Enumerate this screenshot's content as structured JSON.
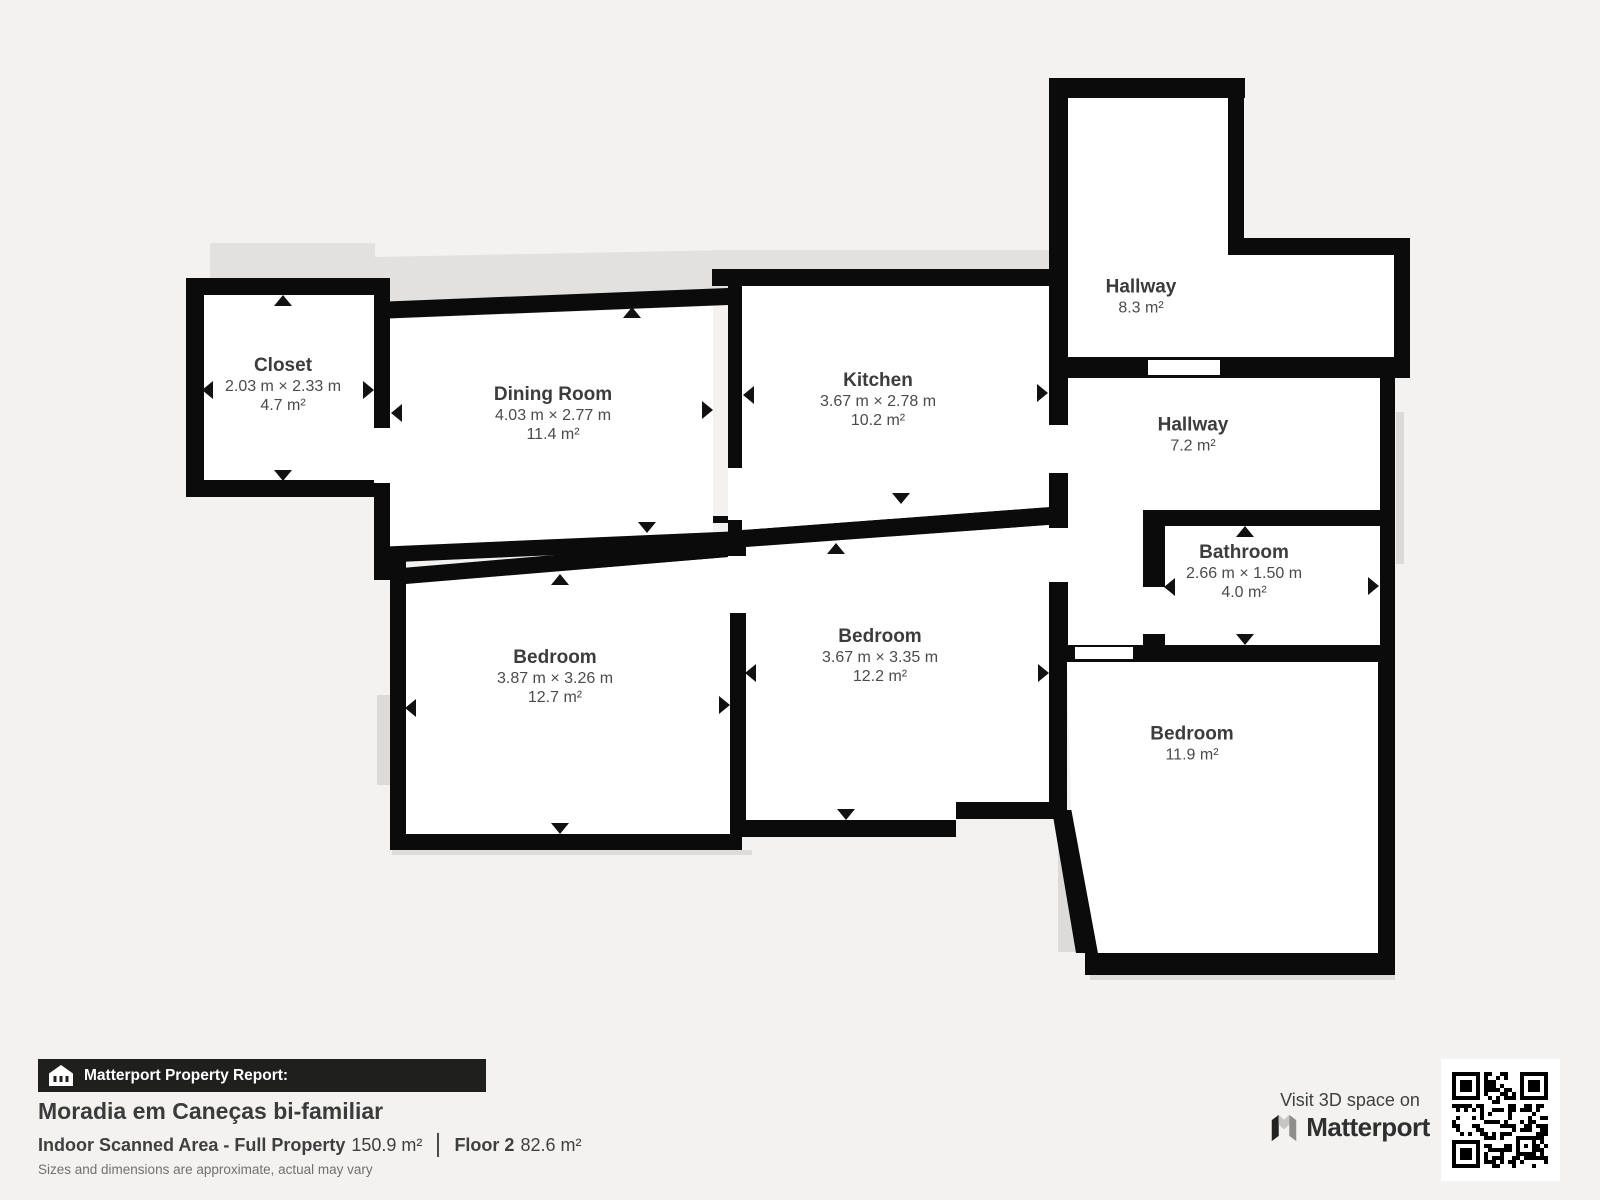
{
  "rooms": [
    {
      "name": "Closet",
      "dims": "2.03 m × 2.33 m",
      "area": "4.7 m²"
    },
    {
      "name": "Dining Room",
      "dims": "4.03 m × 2.77 m",
      "area": "11.4 m²"
    },
    {
      "name": "Kitchen",
      "dims": "3.67 m × 2.78 m",
      "area": "10.2 m²"
    },
    {
      "name": "Hallway",
      "dims": null,
      "area": "8.3 m²"
    },
    {
      "name": "Hallway",
      "dims": null,
      "area": "7.2 m²"
    },
    {
      "name": "Bathroom",
      "dims": "2.66 m × 1.50 m",
      "area": "4.0 m²"
    },
    {
      "name": "Bedroom",
      "dims": "3.87 m × 3.26 m",
      "area": "12.7 m²"
    },
    {
      "name": "Bedroom",
      "dims": "3.67 m × 3.35 m",
      "area": "12.2 m²"
    },
    {
      "name": "Bedroom",
      "dims": null,
      "area": "11.9 m²"
    }
  ],
  "report": {
    "banner": "Matterport Property Report:",
    "property_title": "Moradia em Caneças bi-familiar",
    "scanned_area_label": "Indoor Scanned Area - Full Property",
    "scanned_area_value": "150.9 m²",
    "floor_label": "Floor 2",
    "floor_value": "82.6 m²",
    "disclaimer": "Sizes and dimensions are approximate, actual may vary"
  },
  "promo": {
    "visit_text": "Visit 3D space on",
    "brand_name": "Matterport"
  },
  "colors": {
    "wall": "#0b0b0b",
    "background": "#f3f2f0",
    "room": "#ffffff",
    "shadow": "#e2e1df",
    "text": "#3c3c3c"
  }
}
